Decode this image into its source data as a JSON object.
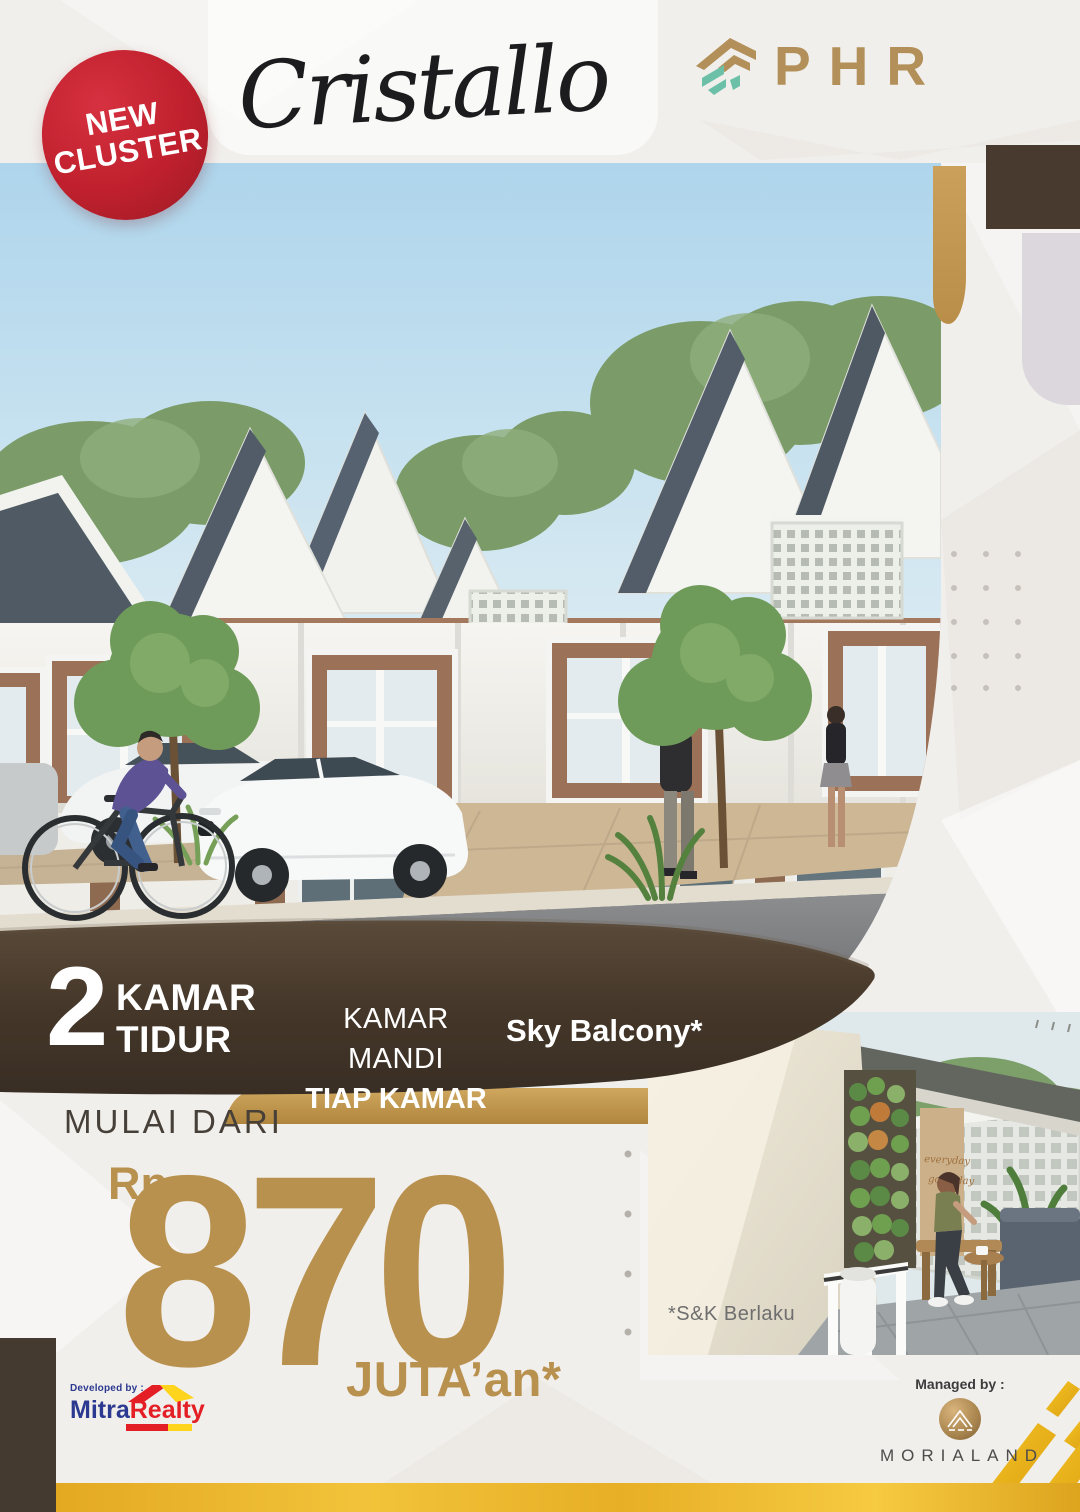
{
  "badge": {
    "line1": "NEW",
    "line2": "CLUSTER"
  },
  "title": "Cristallo",
  "brand": {
    "name": "PHR"
  },
  "features": [
    {
      "big": "2",
      "lines": [
        "KAMAR",
        "TIDUR"
      ]
    },
    {
      "lines": [
        "KAMAR MANDI",
        "TIAP KAMAR"
      ]
    },
    {
      "lines": [
        "Sky Balcony*"
      ]
    }
  ],
  "price": {
    "prefix": "MULAI DARI",
    "currency": "Rp.",
    "amount": "870",
    "suffix": "JUTA’an*"
  },
  "inset": {
    "disclaimer": "*S&K Berlaku",
    "sign_line1": "everyday",
    "sign_line2": "good day"
  },
  "developed_by": {
    "label": "Developed by :",
    "name_part1": "Mitra",
    "name_part2": "Realty"
  },
  "managed_by": {
    "label": "Managed by :",
    "name": "MORIALAND"
  },
  "colors": {
    "badge_red": "#c0202d",
    "band_brown": "#453729",
    "accent_gold": "#b9914f",
    "bright_gold": "#eeb32b",
    "phr_gold": "#b3905a",
    "phr_teal": "#6cc0a8",
    "mitra_blue": "#2b3990",
    "mitra_red": "#e31e25",
    "mitra_yellow": "#ffd41c",
    "text_dark": "#474039",
    "title_black": "#1c1c1e",
    "disclaimer_gray": "#6e6e6e",
    "morialand_gray": "#4c4c4c"
  }
}
